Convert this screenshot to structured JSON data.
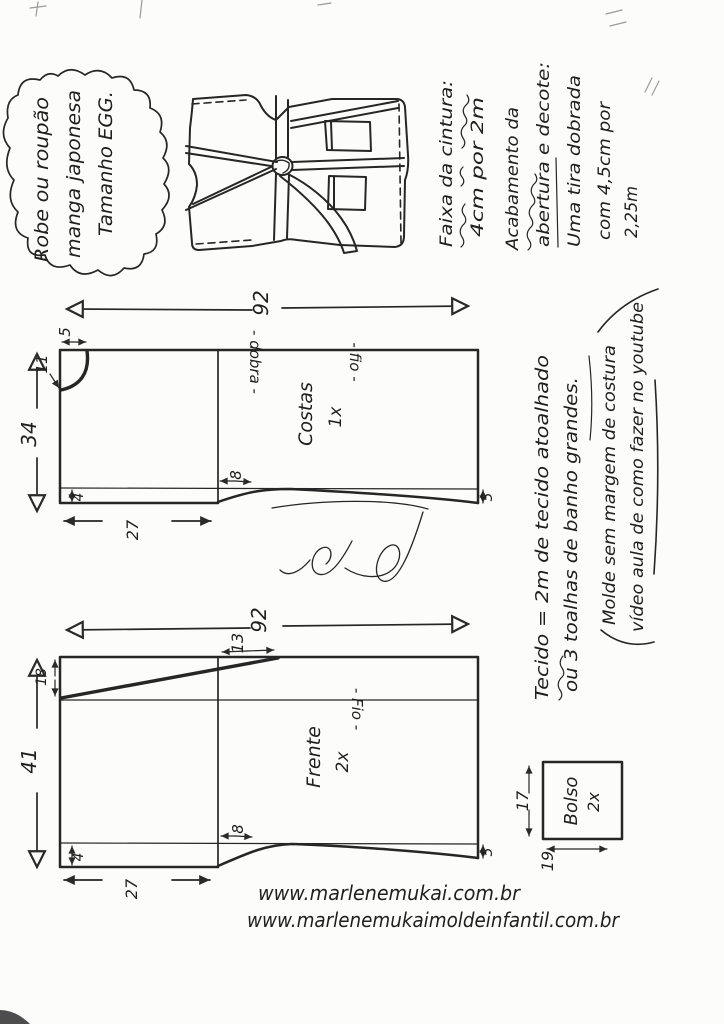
{
  "cloud": {
    "lines": [
      "Robe ou roupão",
      "manga japonesa",
      "Tamanho EGG."
    ]
  },
  "notes_right": {
    "lines": [
      "Faixa da cintura:",
      "4cm por 2m",
      "Acabamento da",
      "abertura e decote:",
      "Uma tira dobrada",
      "com 4,5cm por",
      "2,25m"
    ]
  },
  "notes_fabric": {
    "lines": [
      "Tecido = 2m de tecido atoalhado",
      "ou 3 toalhas de banho grandes."
    ]
  },
  "notes_pattern": {
    "lines": [
      "Molde sem margem de costura",
      "vídeo aula de como fazer no youtube"
    ]
  },
  "pieces": {
    "costas": {
      "name": "Costas",
      "quantity": "1x",
      "grain_label": "- fio -",
      "fold_label": "- dobra -",
      "dims": {
        "length": "92",
        "width": "34",
        "sleeve_hem": "27",
        "hem_band": "4",
        "neck_depth": "11",
        "neck_width": "5",
        "underarm_curve": "8",
        "side_band": "5"
      }
    },
    "frente": {
      "name": "Frente",
      "quantity": "2x",
      "grain_label": "- Fio -",
      "dims": {
        "length": "92",
        "width": "41",
        "sleeve_hem": "27",
        "hem_band": "4",
        "front_drop": "18",
        "shoulder": "13",
        "underarm_curve": "8",
        "side_band": "5"
      }
    },
    "bolso": {
      "name": "Bolso",
      "quantity": "2x",
      "dims": {
        "width": "17",
        "height": "19"
      }
    }
  },
  "websites": [
    "www.marlenemukai.com.br",
    "www.marlenemukaimoldeinfantil.com.br"
  ]
}
